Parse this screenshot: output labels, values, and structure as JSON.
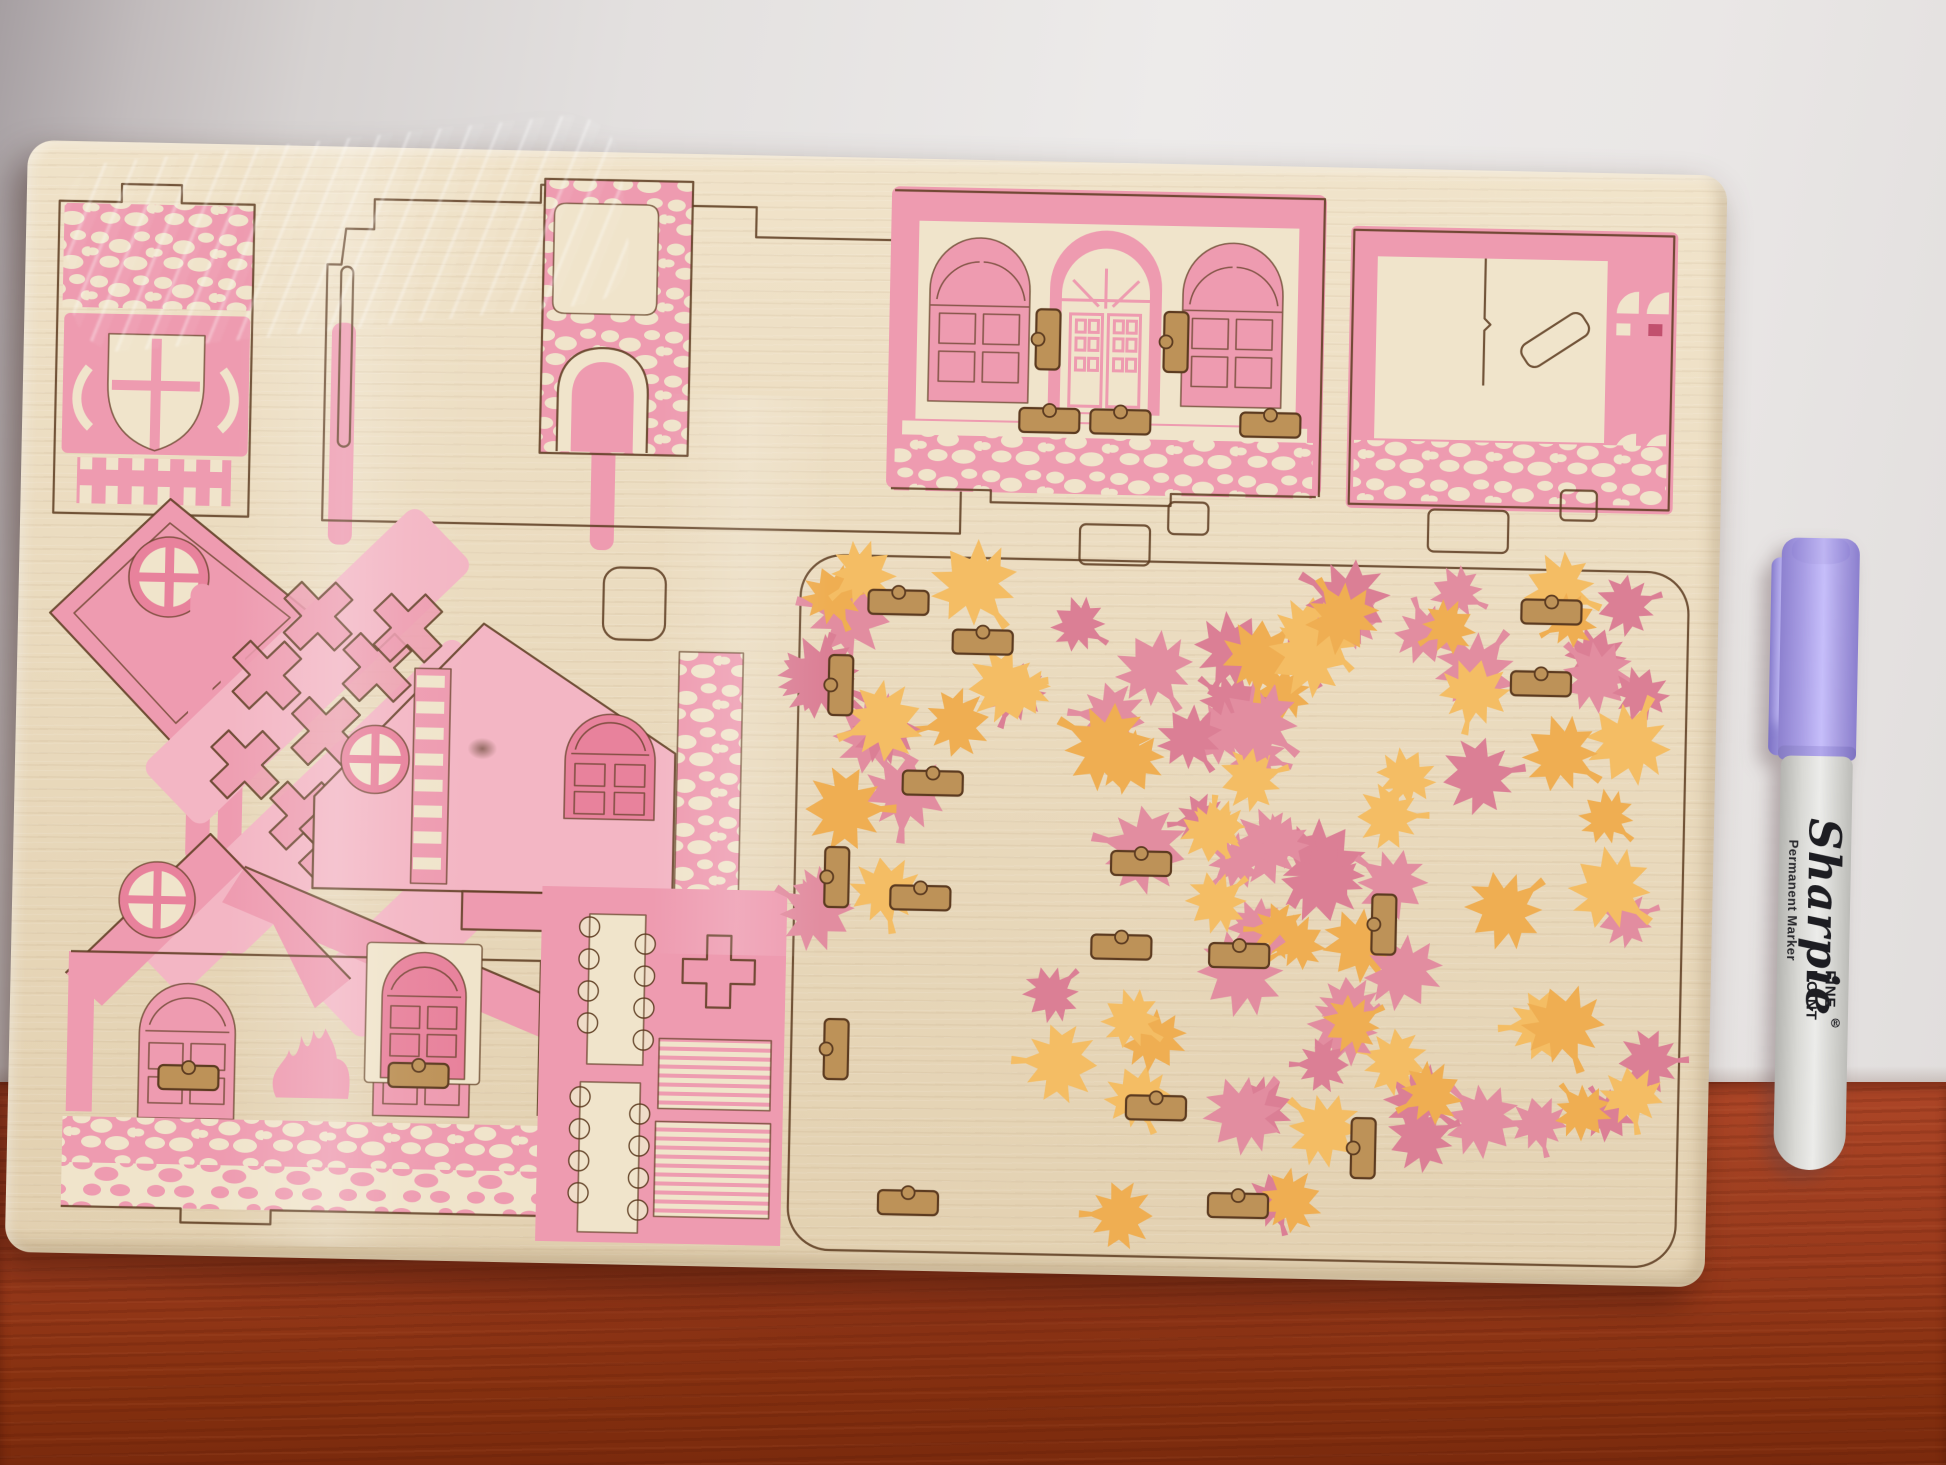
{
  "marker": {
    "brand": "Sharpie",
    "registered": "®",
    "subtext": "Permanent Marker",
    "tip_line1": "FINE",
    "tip_line2": "POINT"
  },
  "colors": {
    "cut": "#5c3b20",
    "pink": "#ee9bb0",
    "pink_light": "#f3b6c4",
    "pink_deep": "#e8829c",
    "cream": "#f0e4cb",
    "slot_wood": "#bd9258",
    "leaf_pink_a": "#e28da0",
    "leaf_pink_b": "#db7f95",
    "leaf_orange_a": "#f4bd64",
    "leaf_orange_b": "#efae52"
  },
  "leaves": {
    "seed": 42,
    "clusters": [
      {
        "x": 800,
        "y": 412,
        "w": 580,
        "h": 185,
        "pink": 12,
        "orange": 10
      },
      {
        "x": 1010,
        "y": 560,
        "w": 360,
        "h": 230,
        "pink": 9,
        "orange": 8
      },
      {
        "x": 1330,
        "y": 412,
        "w": 320,
        "h": 280,
        "pink": 8,
        "orange": 9
      },
      {
        "x": 1365,
        "y": 700,
        "w": 285,
        "h": 360,
        "pink": 9,
        "orange": 8
      },
      {
        "x": 1030,
        "y": 790,
        "w": 330,
        "h": 270,
        "pink": 8,
        "orange": 8
      },
      {
        "x": 790,
        "y": 470,
        "w": 130,
        "h": 290,
        "pink": 5,
        "orange": 3
      },
      {
        "x": 1150,
        "y": 430,
        "w": 200,
        "h": 150,
        "pink": 4,
        "orange": 4
      }
    ]
  },
  "slots": [
    {
      "x": 1012,
      "y": 148,
      "o": "v"
    },
    {
      "x": 1140,
      "y": 148,
      "o": "v"
    },
    {
      "x": 997,
      "y": 247,
      "o": "h"
    },
    {
      "x": 1068,
      "y": 247,
      "o": "h"
    },
    {
      "x": 1218,
      "y": 247,
      "o": "h"
    },
    {
      "x": 150,
      "y": 922,
      "o": "h"
    },
    {
      "x": 380,
      "y": 915,
      "o": "h"
    },
    {
      "x": 850,
      "y": 432,
      "o": "h"
    },
    {
      "x": 935,
      "y": 470,
      "o": "h"
    },
    {
      "x": 812,
      "y": 498,
      "o": "v"
    },
    {
      "x": 812,
      "y": 690,
      "o": "v"
    },
    {
      "x": 815,
      "y": 862,
      "o": "v"
    },
    {
      "x": 888,
      "y": 612,
      "o": "h"
    },
    {
      "x": 1098,
      "y": 688,
      "o": "h"
    },
    {
      "x": 878,
      "y": 727,
      "o": "h"
    },
    {
      "x": 1080,
      "y": 772,
      "o": "h"
    },
    {
      "x": 1198,
      "y": 778,
      "o": "h"
    },
    {
      "x": 1503,
      "y": 428,
      "o": "h"
    },
    {
      "x": 1494,
      "y": 500,
      "o": "h"
    },
    {
      "x": 1360,
      "y": 726,
      "o": "v"
    },
    {
      "x": 1344,
      "y": 950,
      "o": "v"
    },
    {
      "x": 1118,
      "y": 932,
      "o": "h"
    },
    {
      "x": 872,
      "y": 1032,
      "o": "h"
    },
    {
      "x": 1202,
      "y": 1028,
      "o": "h"
    }
  ]
}
